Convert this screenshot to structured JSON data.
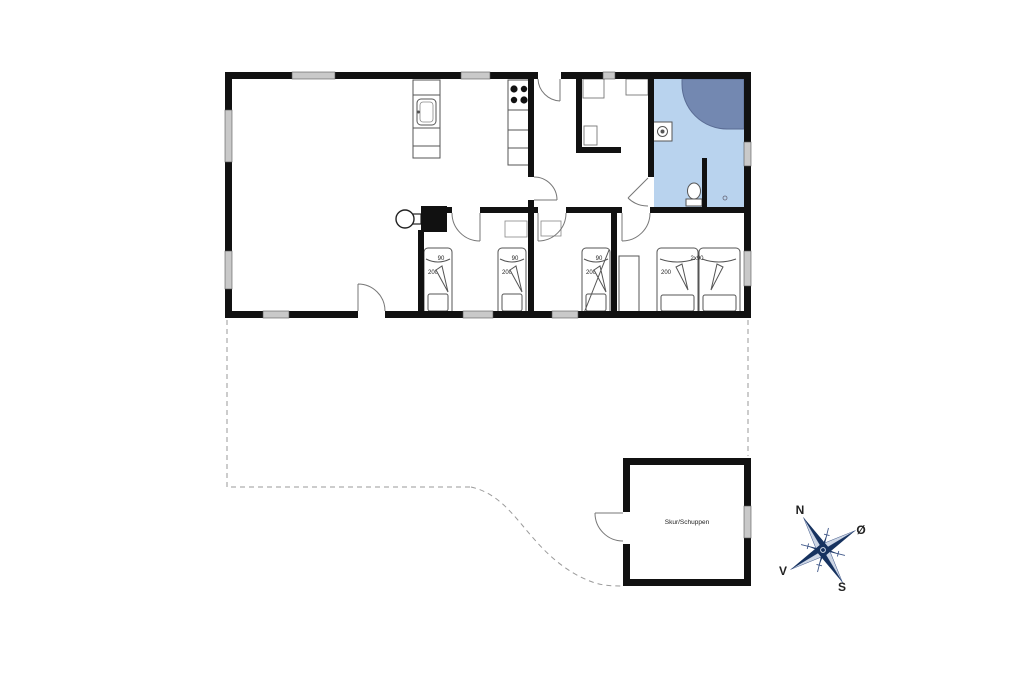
{
  "labels": {
    "shed": "Skur/Schuppen"
  },
  "beds": [
    {
      "width": "90",
      "length": "200"
    },
    {
      "width": "90",
      "length": "200"
    },
    {
      "width": "90",
      "length": "200"
    },
    {
      "width": "2x90",
      "length": "200"
    }
  ],
  "compass": {
    "north": "N",
    "east": "Ø",
    "south": "S",
    "west": "V"
  },
  "colors": {
    "wall": "#111111",
    "window": "#c9c9c9",
    "bathroom_floor": "#b9d3ee",
    "bathtub": "#7388b1",
    "compass": "#16325f",
    "boundary_dash": "#9a9a9a"
  }
}
